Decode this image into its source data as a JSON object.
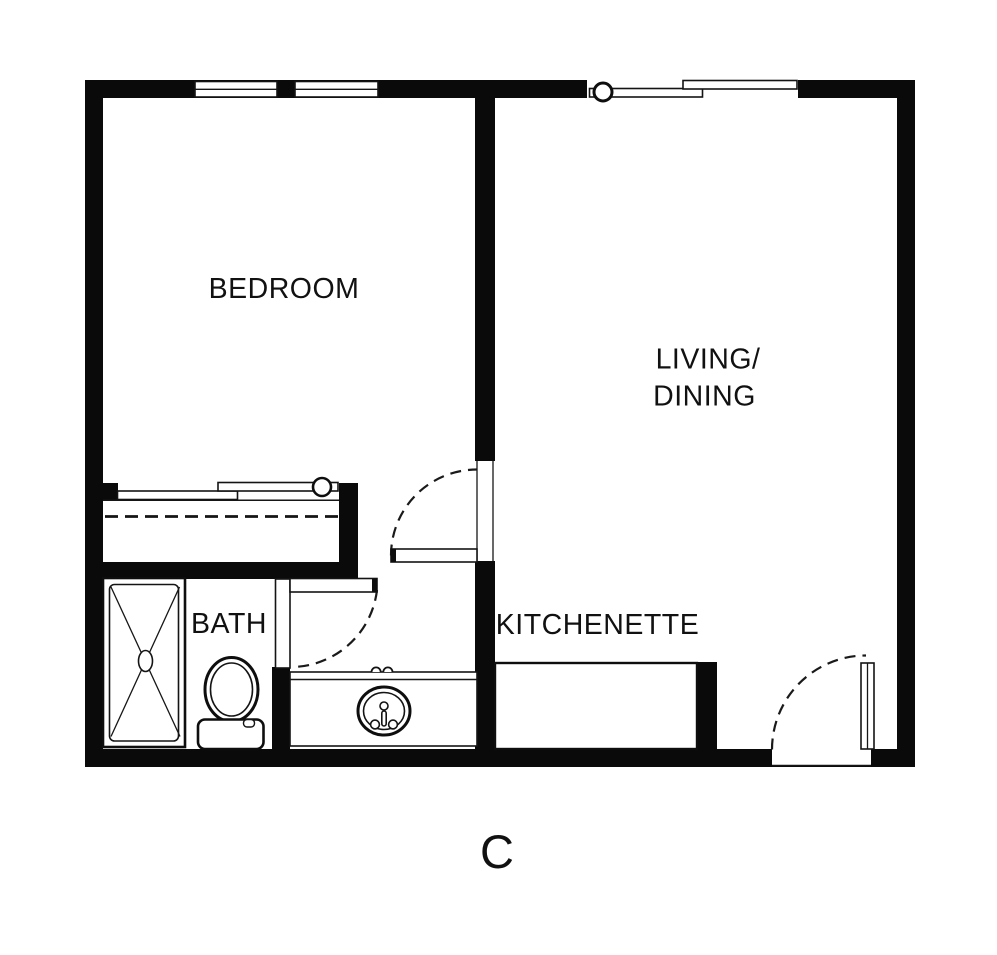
{
  "floorplan": {
    "unit_label": "C",
    "labels": {
      "bedroom": "BEDROOM",
      "living_line1": "LIVING/",
      "living_line2": "DINING",
      "kitchenette": "KITCHENETTE",
      "bath": "BATH"
    },
    "colors": {
      "wall": "#0a0a0a",
      "line": "#161616",
      "background": "#ffffff"
    }
  }
}
